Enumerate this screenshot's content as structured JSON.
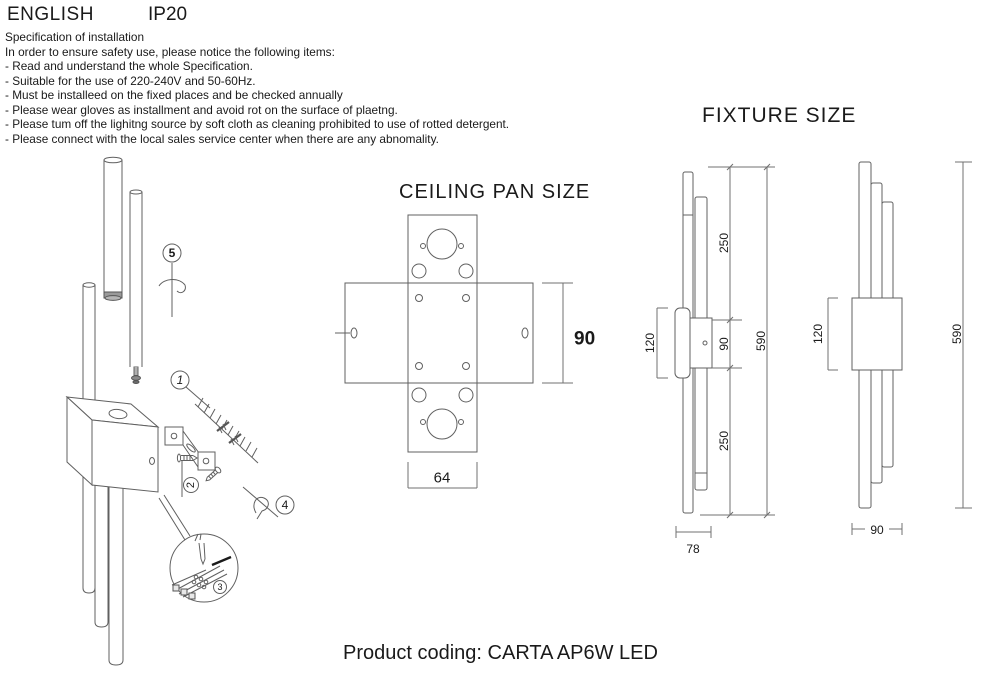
{
  "header": {
    "language": "ENGLISH",
    "ip_rating": "IP20"
  },
  "spec": {
    "title": "Specification of installation",
    "intro": "In order to ensure safety use, please notice the following items:",
    "items": [
      "- Read and understand the whole Specification.",
      "- Suitable for the use of 220-240V and 50-60Hz.",
      "- Must be installeed on the fixed places and be checked annually",
      "- Please wear gloves as installment and avoid rot on the surface of plaetng.",
      "- Please tum off the lighitng source by soft cloth as cleaning prohibited to use of rotted detergent.",
      "- Please connect with the local sales service center when there are any abnomality."
    ]
  },
  "installation": {
    "callout_1": "1",
    "callout_2": "2",
    "callout_3": "3",
    "callout_4": "4",
    "callout_5": "5"
  },
  "ceiling_pan": {
    "title": "CEILING PAN SIZE",
    "dim_height": "90",
    "dim_width": "64"
  },
  "fixture": {
    "title": "FIXTURE SIZE",
    "side": {
      "dim_top": "250",
      "dim_mid": "90",
      "dim_bottom": "250",
      "dim_overall": "590",
      "dim_block": "120",
      "dim_depth": "78"
    },
    "front": {
      "dim_block": "120",
      "dim_overall": "590",
      "dim_width": "90"
    }
  },
  "footer": {
    "product_coding": "Product coding: CARTA AP6W LED"
  }
}
